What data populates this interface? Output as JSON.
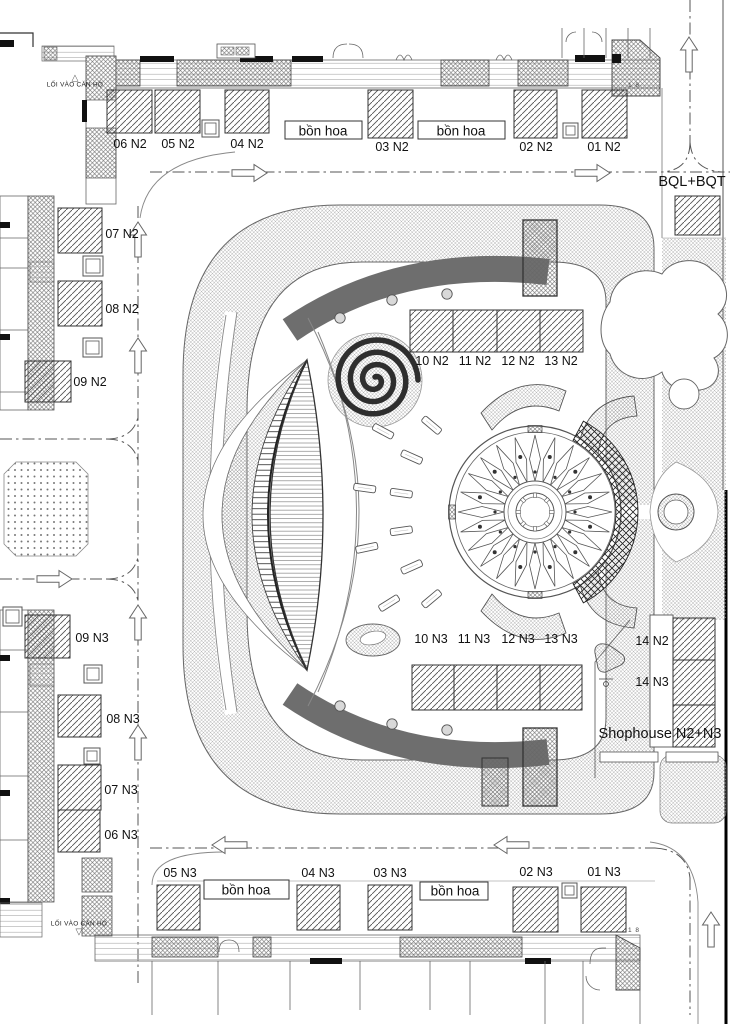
{
  "labels": {
    "units": [
      {
        "text": "06 N2",
        "x": 130,
        "y": 144
      },
      {
        "text": "05 N2",
        "x": 178,
        "y": 144
      },
      {
        "text": "04 N2",
        "x": 247,
        "y": 144
      },
      {
        "text": "03 N2",
        "x": 392,
        "y": 147
      },
      {
        "text": "02 N2",
        "x": 536,
        "y": 147
      },
      {
        "text": "01 N2",
        "x": 604,
        "y": 147
      },
      {
        "text": "07 N2",
        "x": 122,
        "y": 234
      },
      {
        "text": "08 N2",
        "x": 122,
        "y": 309
      },
      {
        "text": "09 N2",
        "x": 90,
        "y": 382
      },
      {
        "text": "10 N2",
        "x": 432,
        "y": 361
      },
      {
        "text": "11 N2",
        "x": 475,
        "y": 361
      },
      {
        "text": "12 N2",
        "x": 518,
        "y": 361
      },
      {
        "text": "13 N2",
        "x": 561,
        "y": 361
      },
      {
        "text": "14 N2",
        "x": 652,
        "y": 641
      },
      {
        "text": "10 N3",
        "x": 431,
        "y": 639
      },
      {
        "text": "11 N3",
        "x": 474,
        "y": 639
      },
      {
        "text": "12 N3",
        "x": 518,
        "y": 639
      },
      {
        "text": "13 N3",
        "x": 561,
        "y": 639
      },
      {
        "text": "14 N3",
        "x": 652,
        "y": 682
      },
      {
        "text": "09 N3",
        "x": 92,
        "y": 638
      },
      {
        "text": "08 N3",
        "x": 123,
        "y": 719
      },
      {
        "text": "07 N3",
        "x": 121,
        "y": 790
      },
      {
        "text": "06 N3",
        "x": 121,
        "y": 835
      },
      {
        "text": "05 N3",
        "x": 180,
        "y": 873
      },
      {
        "text": "04 N3",
        "x": 318,
        "y": 873
      },
      {
        "text": "03 N3",
        "x": 390,
        "y": 873
      },
      {
        "text": "02 N3",
        "x": 536,
        "y": 872
      },
      {
        "text": "01 N3",
        "x": 604,
        "y": 872
      }
    ],
    "areas": [
      {
        "text": "BQL+BQT",
        "x": 692,
        "y": 182
      },
      {
        "text": "Shophouse N2+N3",
        "x": 660,
        "y": 734
      }
    ],
    "flower_beds": [
      {
        "text": "bồn hoa",
        "x": 323,
        "y": 131
      },
      {
        "text": "bồn hoa",
        "x": 461,
        "y": 131
      },
      {
        "text": "bồn hoa",
        "x": 246,
        "y": 890
      },
      {
        "text": "bồn hoa",
        "x": 455,
        "y": 891
      }
    ],
    "entrances": [
      {
        "text": "LỐI VÀO CĂN HỘ",
        "x": 75,
        "y": 82,
        "dir": "up"
      },
      {
        "text": "LỐI VÀO CĂN HỘ",
        "x": 79,
        "y": 929,
        "dir": "down"
      }
    ],
    "section_marks": [
      {
        "text": "1 8",
        "x": 634,
        "y": 86
      },
      {
        "text": "1 8",
        "x": 634,
        "y": 931
      }
    ]
  },
  "colors": {
    "track": "#6e6e6e",
    "line": "#444",
    "paper": "#ffffff"
  }
}
